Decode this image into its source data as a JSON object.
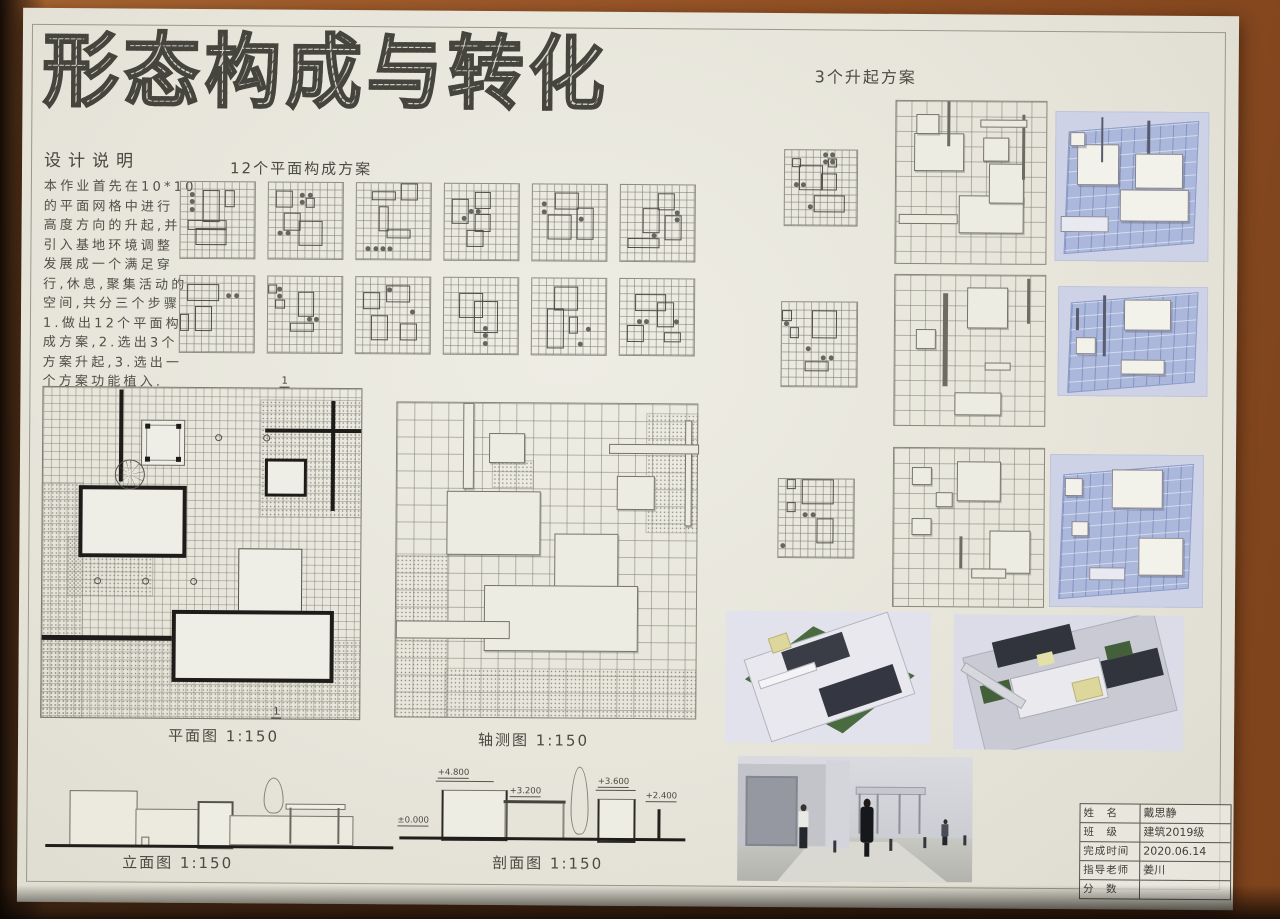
{
  "title": {
    "text": "形态构成与转化",
    "chars": [
      "形",
      "态",
      "构",
      "成",
      "与",
      "转",
      "化"
    ]
  },
  "labels": {
    "rise_schemes": "3个升起方案",
    "plan_schemes": "12个平面构成方案",
    "plan_view": "平面图 1:150",
    "axon_view": "轴测图 1:150",
    "elevation_view": "立面图 1:150",
    "section_view": "剖面图 1:150",
    "section_marker": "1"
  },
  "design_notes": {
    "heading": "设计说明",
    "lines": [
      "本作业首先在10*10",
      "的平面网格中进行",
      "高度方向的升起,并",
      "引入基地环境调整",
      "发展成一个满足穿",
      "行,休息,聚集活动的",
      "空间,共分三个步骤",
      "1.做出12个平面构",
      "成方案,2.选出3个",
      "方案升起,3.选出一",
      "个方案功能植入."
    ]
  },
  "section_levels": {
    "datum": "±0.000",
    "l1": "+4.800",
    "l2": "+3.200",
    "l3": "+3.600",
    "l4": "+2.400"
  },
  "info_table": {
    "rows": [
      {
        "label": "姓　名",
        "value": "戴思静"
      },
      {
        "label": "班　级",
        "value": "建筑2019级"
      },
      {
        "label": "完成时间",
        "value": "2020.06.14"
      },
      {
        "label": "指导老师",
        "value": "姜川"
      },
      {
        "label": "分　数",
        "value": ""
      }
    ]
  },
  "colors": {
    "paper": "#e8e6dc",
    "wood": "#9a5628",
    "ink": "#4c4b44",
    "wall": "#1d1c18",
    "render_bg": "#cdd2e6",
    "render_plane": "#abb8dc",
    "model_bg": "#dfe0ea",
    "lawn": "#4a6a40",
    "roof": "#343741",
    "canopy": "#ddd79b",
    "sky": "#dadbe0"
  },
  "plan_grids": [
    {
      "rects": [
        [
          3,
          1,
          2,
          4
        ],
        [
          6,
          1,
          1,
          2
        ],
        [
          1,
          5,
          5,
          1
        ],
        [
          2,
          6,
          4,
          2
        ]
      ],
      "dots": [
        [
          1,
          1
        ],
        [
          1,
          2
        ],
        [
          1,
          3
        ]
      ]
    },
    {
      "rects": [
        [
          1,
          1,
          2,
          2
        ],
        [
          2,
          4,
          2,
          2
        ],
        [
          5,
          2,
          1,
          1
        ],
        [
          4,
          5,
          3,
          3
        ]
      ],
      "dots": [
        [
          4,
          1
        ],
        [
          5,
          1
        ],
        [
          4,
          2
        ],
        [
          1,
          6
        ],
        [
          2,
          6
        ]
      ]
    },
    {
      "rects": [
        [
          2,
          1,
          3,
          1
        ],
        [
          6,
          0,
          2,
          2
        ],
        [
          3,
          3,
          1,
          3
        ],
        [
          4,
          6,
          3,
          1
        ]
      ],
      "dots": [
        [
          1,
          8
        ],
        [
          2,
          8
        ],
        [
          3,
          8
        ],
        [
          4,
          8
        ]
      ]
    },
    {
      "rects": [
        [
          1,
          2,
          2,
          3
        ],
        [
          4,
          1,
          2,
          2
        ],
        [
          4,
          4,
          2,
          2
        ],
        [
          3,
          6,
          2,
          2
        ]
      ],
      "dots": [
        [
          3,
          3
        ],
        [
          4,
          3
        ],
        [
          2,
          4
        ]
      ]
    },
    {
      "rects": [
        [
          3,
          1,
          3,
          2
        ],
        [
          2,
          4,
          3,
          3
        ],
        [
          6,
          3,
          2,
          4
        ]
      ],
      "dots": [
        [
          1,
          2
        ],
        [
          1,
          3
        ],
        [
          6,
          4
        ]
      ]
    },
    {
      "rects": [
        [
          5,
          1,
          2,
          2
        ],
        [
          3,
          3,
          2,
          3
        ],
        [
          6,
          4,
          2,
          3
        ],
        [
          1,
          7,
          4,
          1
        ]
      ],
      "dots": [
        [
          7,
          3
        ],
        [
          7,
          4
        ],
        [
          4,
          6
        ]
      ]
    },
    {
      "rects": [
        [
          1,
          1,
          4,
          2
        ],
        [
          2,
          4,
          2,
          3
        ],
        [
          0,
          5,
          1,
          2
        ]
      ],
      "dots": [
        [
          6,
          2
        ],
        [
          7,
          2
        ]
      ]
    },
    {
      "rects": [
        [
          4,
          2,
          2,
          3
        ],
        [
          1,
          3,
          1,
          1
        ],
        [
          3,
          6,
          3,
          1
        ],
        [
          0,
          1,
          1,
          1
        ]
      ],
      "dots": [
        [
          1,
          1
        ],
        [
          1,
          2
        ],
        [
          5,
          5
        ],
        [
          6,
          5
        ]
      ]
    },
    {
      "rects": [
        [
          1,
          2,
          2,
          2
        ],
        [
          4,
          1,
          3,
          2
        ],
        [
          2,
          5,
          2,
          3
        ],
        [
          6,
          6,
          2,
          2
        ]
      ],
      "dots": [
        [
          4,
          1
        ],
        [
          7,
          4
        ]
      ]
    },
    {
      "rects": [
        [
          2,
          2,
          3,
          3
        ],
        [
          4,
          3,
          3,
          4
        ]
      ],
      "dots": [
        [
          5,
          6
        ],
        [
          5,
          7
        ],
        [
          5,
          8
        ]
      ]
    },
    {
      "rects": [
        [
          3,
          1,
          3,
          3
        ],
        [
          2,
          4,
          2,
          5
        ],
        [
          5,
          5,
          1,
          2
        ]
      ],
      "dots": [
        [
          6,
          8
        ],
        [
          7,
          6
        ]
      ]
    },
    {
      "rects": [
        [
          2,
          2,
          4,
          2
        ],
        [
          5,
          3,
          2,
          3
        ],
        [
          1,
          6,
          2,
          2
        ],
        [
          6,
          7,
          2,
          1
        ]
      ],
      "dots": [
        [
          2,
          5
        ],
        [
          3,
          5
        ],
        [
          7,
          5
        ]
      ]
    }
  ],
  "rise_schemes": [
    {
      "grid": {
        "rects": [
          [
            1,
            1,
            1,
            1
          ],
          [
            2,
            2,
            3,
            3
          ],
          [
            6,
            1,
            1,
            1
          ],
          [
            5,
            3,
            2,
            2
          ],
          [
            4,
            6,
            4,
            2
          ]
        ],
        "dots": [
          [
            5,
            0
          ],
          [
            6,
            0
          ],
          [
            5,
            1
          ],
          [
            6,
            1
          ],
          [
            1,
            4
          ],
          [
            2,
            4
          ],
          [
            3,
            7
          ]
        ]
      },
      "axon": [
        {
          "t": "box",
          "x": 12,
          "y": 20,
          "w": 32,
          "h": 22
        },
        {
          "t": "box",
          "x": 13,
          "y": 8,
          "w": 14,
          "h": 11
        },
        {
          "t": "box",
          "x": 58,
          "y": 22,
          "w": 16,
          "h": 14
        },
        {
          "t": "box",
          "x": 42,
          "y": 58,
          "w": 42,
          "h": 22
        },
        {
          "t": "box",
          "x": 62,
          "y": 38,
          "w": 22,
          "h": 24
        },
        {
          "t": "pole",
          "x": 34,
          "y": 0,
          "w": 2,
          "h": 28
        },
        {
          "t": "pole",
          "x": 84,
          "y": 8,
          "w": 2,
          "h": 40
        },
        {
          "t": "hbar",
          "x": 56,
          "y": 11,
          "w": 30,
          "h": 4
        },
        {
          "t": "hbar",
          "x": 2,
          "y": 70,
          "w": 38,
          "h": 5
        }
      ],
      "render": [
        {
          "t": "box",
          "x": 14,
          "y": 22,
          "w": 26,
          "h": 26
        },
        {
          "t": "box",
          "x": 52,
          "y": 28,
          "w": 30,
          "h": 22
        },
        {
          "t": "box",
          "x": 42,
          "y": 52,
          "w": 44,
          "h": 20
        },
        {
          "t": "box",
          "x": 10,
          "y": 14,
          "w": 8,
          "h": 8
        },
        {
          "t": "pole",
          "x": 30,
          "y": 4,
          "w": 1.5,
          "h": 30
        },
        {
          "t": "pole",
          "x": 60,
          "y": 6,
          "w": 1.5,
          "h": 22
        },
        {
          "t": "hbar",
          "x": 4,
          "y": 70,
          "w": 30,
          "h": 9
        }
      ]
    },
    {
      "grid": {
        "rects": [
          [
            4,
            1,
            3,
            3
          ],
          [
            1,
            3,
            1,
            1
          ],
          [
            3,
            7,
            3,
            1
          ],
          [
            0,
            1,
            1,
            1
          ]
        ],
        "dots": [
          [
            0,
            2
          ],
          [
            5,
            6
          ],
          [
            6,
            6
          ],
          [
            3,
            5
          ]
        ]
      },
      "axon": [
        {
          "t": "box",
          "x": 48,
          "y": 8,
          "w": 26,
          "h": 26
        },
        {
          "t": "pole",
          "x": 32,
          "y": 12,
          "w": 3,
          "h": 62
        },
        {
          "t": "box",
          "x": 14,
          "y": 36,
          "w": 12,
          "h": 12
        },
        {
          "t": "box",
          "x": 40,
          "y": 78,
          "w": 30,
          "h": 14
        },
        {
          "t": "hbar",
          "x": 60,
          "y": 58,
          "w": 16,
          "h": 4
        },
        {
          "t": "pole",
          "x": 88,
          "y": 2,
          "w": 2,
          "h": 30
        }
      ],
      "render": [
        {
          "t": "box",
          "x": 44,
          "y": 12,
          "w": 30,
          "h": 26
        },
        {
          "t": "box",
          "x": 12,
          "y": 46,
          "w": 12,
          "h": 14
        },
        {
          "t": "pole",
          "x": 30,
          "y": 8,
          "w": 2,
          "h": 56
        },
        {
          "t": "box",
          "x": 42,
          "y": 66,
          "w": 28,
          "h": 12
        },
        {
          "t": "pole",
          "x": 12,
          "y": 20,
          "w": 2,
          "h": 20
        }
      ]
    },
    {
      "grid": {
        "rects": [
          [
            3,
            0,
            4,
            3
          ],
          [
            1,
            0,
            1,
            1
          ],
          [
            1,
            3,
            1,
            1
          ],
          [
            5,
            5,
            2,
            3
          ]
        ],
        "dots": [
          [
            3,
            4
          ],
          [
            4,
            4
          ],
          [
            0,
            8
          ]
        ]
      },
      "axon": [
        {
          "t": "box",
          "x": 42,
          "y": 8,
          "w": 28,
          "h": 24
        },
        {
          "t": "box",
          "x": 12,
          "y": 12,
          "w": 12,
          "h": 10
        },
        {
          "t": "box",
          "x": 28,
          "y": 28,
          "w": 10,
          "h": 8
        },
        {
          "t": "box",
          "x": 12,
          "y": 44,
          "w": 12,
          "h": 10
        },
        {
          "t": "box",
          "x": 64,
          "y": 52,
          "w": 26,
          "h": 26
        },
        {
          "t": "hbar",
          "x": 52,
          "y": 76,
          "w": 22,
          "h": 5
        },
        {
          "t": "pole",
          "x": 44,
          "y": 56,
          "w": 2,
          "h": 20
        }
      ],
      "render": [
        {
          "t": "box",
          "x": 40,
          "y": 10,
          "w": 32,
          "h": 24
        },
        {
          "t": "box",
          "x": 10,
          "y": 16,
          "w": 10,
          "h": 10
        },
        {
          "t": "box",
          "x": 58,
          "y": 54,
          "w": 28,
          "h": 24
        },
        {
          "t": "box",
          "x": 14,
          "y": 44,
          "w": 10,
          "h": 8
        },
        {
          "t": "hbar",
          "x": 26,
          "y": 74,
          "w": 22,
          "h": 7
        }
      ]
    }
  ]
}
